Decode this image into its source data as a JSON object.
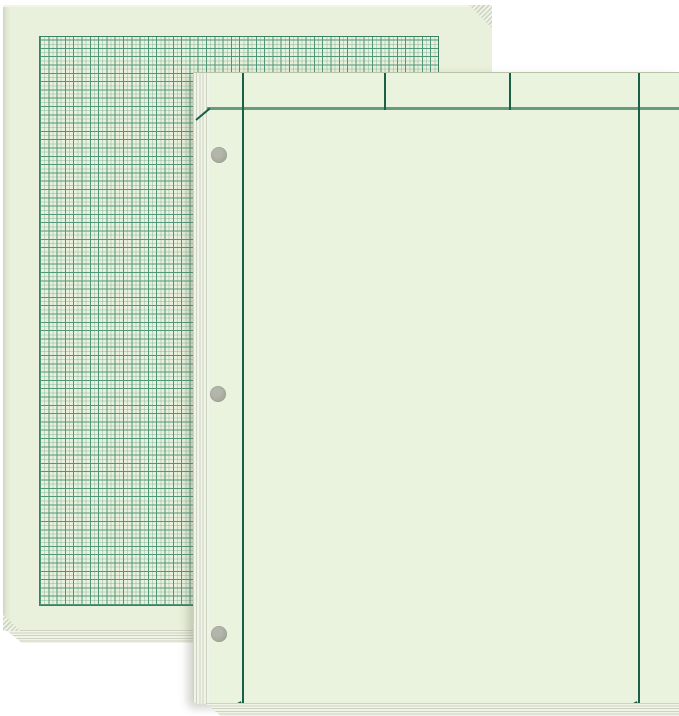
{
  "canvas": {
    "width": 679,
    "height": 716,
    "background": "#ffffff"
  },
  "palette": {
    "white_bg": "#ffffff",
    "paper_back": "#e9f0db",
    "paper_front": "#eaf3de",
    "grid_strong": "#4e9579",
    "grid_faint": "rgba(78,149,121,0.30)",
    "grid_border": "#3b8164",
    "rule_dark": "#1c5f49",
    "rule_soft": "#679b7e",
    "hole_gray": "#a8aba0",
    "hole_gray_dark": "#999d90",
    "stack_light": "#f0f3e7",
    "stack_mid": "#ccd3bf",
    "edge_shade": "#cdd4bf",
    "front_shadow": "rgba(96,106,84,0.30)"
  },
  "back_pad": {
    "rect": {
      "x": 3,
      "y": 5,
      "w": 489,
      "h": 626
    },
    "grid": {
      "x": 39,
      "y": 34,
      "w": 398,
      "h": 568,
      "cell_px": 8.3
    },
    "bottom_stack": {
      "x": 4,
      "y": 630,
      "w": 240,
      "h": 13
    },
    "corner_tr": {
      "x": 469,
      "y": 5,
      "w": 23,
      "h": 23
    },
    "corner_bl": {
      "x": 3,
      "y": 614,
      "w": 17,
      "h": 17
    }
  },
  "front_pad": {
    "rect": {
      "x": 193,
      "y": 72,
      "w": 486,
      "h": 631
    },
    "left_stack_w": 16,
    "hole_diameter_px": 16,
    "holes": [
      {
        "cx": 219,
        "cy": 154
      },
      {
        "cx": 218,
        "cy": 393
      },
      {
        "cx": 219,
        "cy": 633
      }
    ],
    "header": {
      "line_y": 106,
      "line_start_x": 207
    },
    "rules": {
      "vertical": [
        {
          "name": "left-margin-rule",
          "x": 242,
          "full": true
        },
        {
          "name": "header-divider-1",
          "x": 384,
          "full": false
        },
        {
          "name": "header-divider-2",
          "x": 509,
          "full": false
        },
        {
          "name": "right-margin-rule",
          "x": 638,
          "full": true
        }
      ],
      "ticks": [
        {
          "name": "header-left-tick",
          "x": 196,
          "y": 118,
          "len": 18,
          "angle": -40
        },
        {
          "name": "left-margin-bottom-tick",
          "x": 228,
          "y": 707,
          "len": 15,
          "angle": -28
        },
        {
          "name": "right-margin-bottom-tick",
          "x": 624,
          "y": 707,
          "len": 15,
          "angle": -28
        }
      ]
    },
    "bottom_stack": {
      "x": 205,
      "y": 703,
      "w": 474,
      "h": 13
    }
  }
}
